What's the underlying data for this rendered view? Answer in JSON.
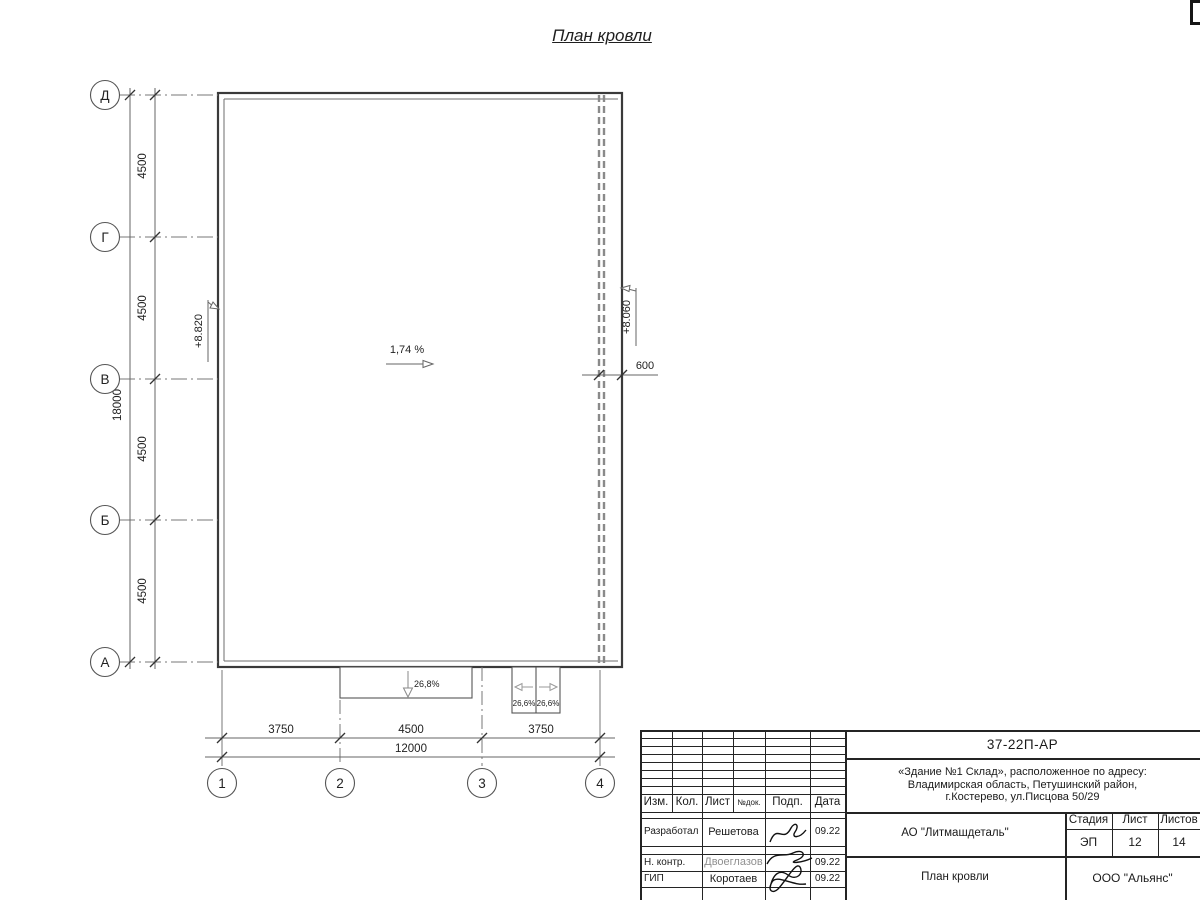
{
  "page_title": "План кровли",
  "plan": {
    "row_axes": [
      "Д",
      "Г",
      "В",
      "Б",
      "А"
    ],
    "col_axes": [
      "1",
      "2",
      "3",
      "4"
    ],
    "v_dims": [
      "4500",
      "4500",
      "4500",
      "4500"
    ],
    "v_total": "18000",
    "h_dims": [
      "3750",
      "4500",
      "3750"
    ],
    "h_total": "12000",
    "elev_left": "+8.820",
    "elev_right": "+8.060",
    "offset_dim": "600",
    "slope_main": "1,74 %",
    "slope_canopy": "26,8%",
    "slope_dock_left": "26,6%",
    "slope_dock_right": "26,6%"
  },
  "titleblock": {
    "doc_number": "37-22П-АР",
    "address_line1": "«Здание №1 Склад», расположенное по адресу:",
    "address_line2": "Владимирская область, Петушинский район,",
    "address_line3": "г.Костерево, ул.Писцова 50/29",
    "header": {
      "izm": "Изм.",
      "kol": "Кол.",
      "list": "Лист",
      "ndoc": "№док.",
      "podp": "Подп.",
      "data": "Дата"
    },
    "rows": [
      {
        "role": "Разработал",
        "name": "Решетова",
        "date": "09.22"
      },
      {
        "role": "Н. контр.",
        "name": "Двоеглазов",
        "date": "09.22"
      },
      {
        "role": "ГИП",
        "name": "Коротаев",
        "date": "09.22"
      }
    ],
    "company": "АО \"Литмашдеталь\"",
    "stage_label": "Стадия",
    "sheet_label": "Лист",
    "sheets_label": "Листов",
    "stage": "ЭП",
    "sheet": "12",
    "sheets": "14",
    "drawing_name": "План кровли",
    "org": "ООО \"Альянс\""
  },
  "colors": {
    "line_dark": "#3a3a3a",
    "line_mid": "#555555",
    "line_dash": "#8a8a8a",
    "text": "#222222"
  }
}
